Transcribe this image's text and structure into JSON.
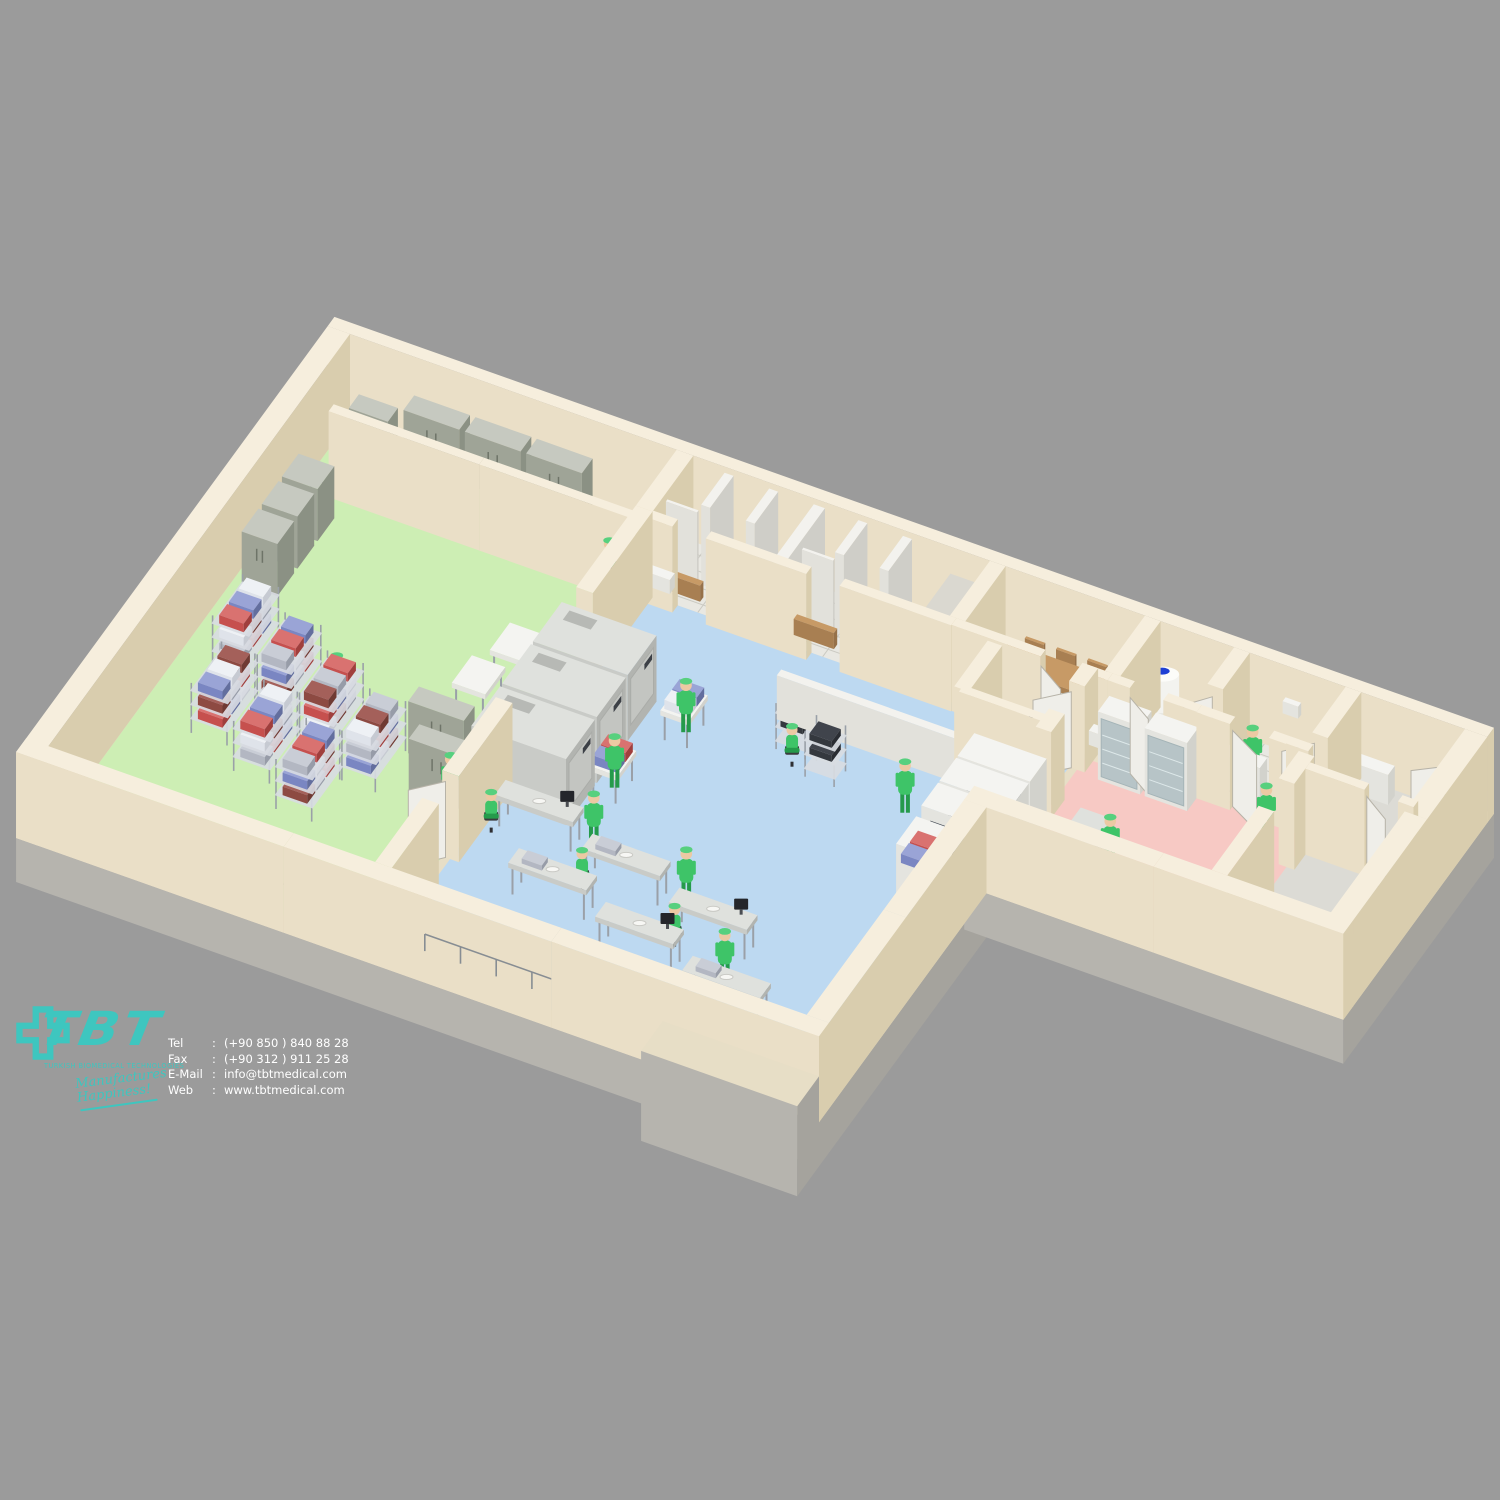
{
  "branding": {
    "logo_text": "TBT",
    "logo_subtitle": "TURKISH BIOMEDICAL TECHNOLOGIES",
    "tagline": "Manufactures Happiness!",
    "logo_color": "#3ec6bf"
  },
  "contact": {
    "rows": [
      {
        "label": "Tel",
        "sep": ":",
        "value": "(+90 850 ) 840 88 28"
      },
      {
        "label": "Fax",
        "sep": ":",
        "value": "(+90 312 ) 911 25 28"
      },
      {
        "label": "E-Mail",
        "sep": ":",
        "value": "info@tbtmedical.com"
      },
      {
        "label": "Web",
        "sep": ":",
        "value": "www.tbtmedical.com"
      }
    ]
  },
  "scene": {
    "description": "Isometric 3D cutaway render of a sterile processing department floor plan",
    "staff_count": 17,
    "zones": [
      {
        "id": "sterile-storage-zone",
        "floor_color": "#cdeeb4"
      },
      {
        "id": "packing-clean-zone",
        "floor_color": "#bdd9f1"
      },
      {
        "id": "decontamination-zone",
        "floor_color": "#f7c9c4"
      },
      {
        "id": "changing-rooms",
        "floor_color": "#e9e8e2"
      },
      {
        "id": "meeting-room",
        "floor_color": "#f0e9d8"
      },
      {
        "id": "technical-annex",
        "floor_color": "#dcdbd5"
      }
    ],
    "equipment": {
      "storage_cabinets": 9,
      "shelving_racks": 7,
      "sterilizers": 3,
      "washer_disinfectors": 3,
      "work_tables": 6,
      "glass_cabinets": 2,
      "water_tank": 1,
      "meeting_table": 1
    },
    "palette": {
      "bg": "#9b9b9b",
      "ground": "#e7dec6",
      "slab": [
        "#b6b4ae",
        "#a5a39d"
      ],
      "wall": [
        "#f6eedd",
        "#eadfc7",
        "#d9cdae"
      ],
      "wallWhite": [
        "#f3f2ee",
        "#e2e1db",
        "#cfcec8"
      ],
      "floorGreen": "#cdeeb4",
      "floorBlue": "#bdd9f1",
      "floorPink": "#f7c9c4",
      "floorTile": "#e9e8e2",
      "tileLine": "#cbcac2",
      "floorCream": "#f0e9d8",
      "floorGray": "#dcdbd5",
      "cabinet": [
        "#c6c9c0",
        "#9fa497",
        "#8b9184"
      ],
      "machine": [
        "#dfe1dd",
        "#c9cbc7",
        "#b2b4b0"
      ],
      "whiteBox": [
        "#f4f4f1",
        "#e4e4df",
        "#d2d2cc"
      ],
      "wood": [
        "#c79a66",
        "#a87f52",
        "#96714a"
      ],
      "glass": "#b4c2c6",
      "windowDark": "#434a54",
      "windowInner": "#8fa0aa",
      "metal": "#9aa0a8",
      "rail": "#878d93",
      "green": "#3ec468",
      "greenDark": "#259a4b",
      "cap": "#57d07e",
      "skin": "#ecc9a3",
      "chairDark": "#3b3b3e",
      "contBlue": [
        "#9aa4d6",
        "#7a86c2",
        "#636e9e"
      ],
      "contRed": [
        "#d97270",
        "#c6504e",
        "#a03f3d"
      ],
      "contGray": [
        "#c9cdd6",
        "#b3b7c2",
        "#979ca8"
      ],
      "contDarkRed": [
        "#a4605a",
        "#8d4a42",
        "#703a33"
      ],
      "contWhite": [
        "#eef1f5",
        "#dfe3ea",
        "#c6cad2"
      ],
      "waterBlue": "#1e3fd4",
      "shelf": "#d8dce2"
    }
  }
}
